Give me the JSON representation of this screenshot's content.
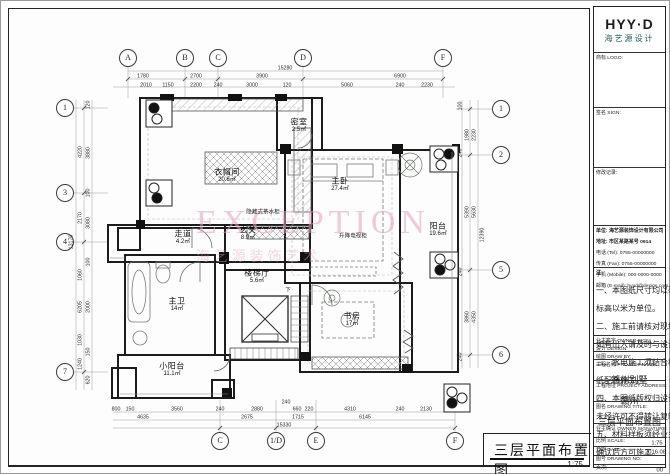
{
  "logo": {
    "title": "HYY·D",
    "subtitle": "海艺源设计"
  },
  "plan_title": {
    "text": "三层平面布置图",
    "scale": "1:75"
  },
  "watermark": {
    "text": "EXCEPTION",
    "cjk": "海 艺 源 装 饰 艺 术"
  },
  "colors": {
    "line": "#1c1c1c",
    "watermark_pink": "#e3a0be",
    "logo_teal": "#1b5e5a"
  },
  "grid_bubbles": [
    {
      "label": "A",
      "x": 128,
      "y": 58
    },
    {
      "label": "B",
      "x": 185,
      "y": 58
    },
    {
      "label": "C",
      "x": 218,
      "y": 58
    },
    {
      "label": "D",
      "x": 303,
      "y": 58
    },
    {
      "label": "F",
      "x": 443,
      "y": 58
    },
    {
      "label": "C",
      "x": 220,
      "y": 441
    },
    {
      "label": "1/D",
      "x": 276,
      "y": 441
    },
    {
      "label": "E",
      "x": 316,
      "y": 441
    },
    {
      "label": "F",
      "x": 455,
      "y": 441
    },
    {
      "label": "1",
      "x": 65,
      "y": 108
    },
    {
      "label": "3",
      "x": 65,
      "y": 193
    },
    {
      "label": "4",
      "x": 65,
      "y": 242
    },
    {
      "label": "7",
      "x": 65,
      "y": 372
    },
    {
      "label": "1",
      "x": 501,
      "y": 109
    },
    {
      "label": "2",
      "x": 501,
      "y": 155
    },
    {
      "label": "5",
      "x": 501,
      "y": 270
    },
    {
      "label": "6",
      "x": 501,
      "y": 355
    }
  ],
  "rooms": [
    {
      "name": "密室",
      "area": "2.5㎡",
      "x": 299,
      "y": 126
    },
    {
      "name": "衣帽间",
      "area": "20.6㎡",
      "x": 227,
      "y": 176
    },
    {
      "name": "主卧",
      "area": "27.4㎡",
      "x": 340,
      "y": 185
    },
    {
      "name": "阳台",
      "area": "19.6㎡",
      "x": 438,
      "y": 230
    },
    {
      "name": "走道",
      "area": "4.2㎡",
      "x": 183,
      "y": 238
    },
    {
      "name": "玄关",
      "area": "8.9㎡",
      "x": 248,
      "y": 234
    },
    {
      "name": "楼梯厅",
      "area": "5.6㎡",
      "x": 257,
      "y": 277
    },
    {
      "name": "主卫",
      "area": "14㎡",
      "x": 177,
      "y": 305
    },
    {
      "name": "书房",
      "area": "17㎡",
      "x": 352,
      "y": 320
    },
    {
      "name": "小阳台",
      "area": "11.1㎡",
      "x": 172,
      "y": 370
    }
  ],
  "annotations": [
    {
      "text": "隐藏式茶水柜",
      "x": 263,
      "y": 212
    },
    {
      "text": "升降电视柜",
      "x": 353,
      "y": 236
    },
    {
      "text": "下",
      "x": 288,
      "y": 290
    }
  ],
  "dims_top": [
    {
      "t": "15280",
      "x": 285,
      "y": 68
    },
    {
      "t": "1780",
      "x": 143,
      "y": 76
    },
    {
      "t": "2700",
      "x": 196,
      "y": 76
    },
    {
      "t": "3900",
      "x": 262,
      "y": 76
    },
    {
      "t": "6900",
      "x": 400,
      "y": 76
    },
    {
      "t": "2010",
      "x": 146,
      "y": 85
    },
    {
      "t": "1150",
      "x": 168,
      "y": 85
    },
    {
      "t": "2200",
      "x": 196,
      "y": 85
    },
    {
      "t": "240",
      "x": 218,
      "y": 85
    },
    {
      "t": "3000",
      "x": 252,
      "y": 85
    },
    {
      "t": "120",
      "x": 287,
      "y": 85
    },
    {
      "t": "5060",
      "x": 347,
      "y": 85
    },
    {
      "t": "240",
      "x": 400,
      "y": 85
    },
    {
      "t": "2230",
      "x": 427,
      "y": 85
    }
  ],
  "dims_bottom": [
    {
      "t": "240",
      "x": 286,
      "y": 402
    },
    {
      "t": "800",
      "x": 116,
      "y": 409
    },
    {
      "t": "150",
      "x": 130,
      "y": 409
    },
    {
      "t": "3560",
      "x": 177,
      "y": 409
    },
    {
      "t": "240",
      "x": 220,
      "y": 409
    },
    {
      "t": "2880",
      "x": 257,
      "y": 409
    },
    {
      "t": "660",
      "x": 297,
      "y": 409
    },
    {
      "t": "220",
      "x": 309,
      "y": 409
    },
    {
      "t": "4310",
      "x": 350,
      "y": 409
    },
    {
      "t": "240",
      "x": 400,
      "y": 409
    },
    {
      "t": "2130",
      "x": 426,
      "y": 409
    },
    {
      "t": "4635",
      "x": 143,
      "y": 417
    },
    {
      "t": "2675",
      "x": 247,
      "y": 417
    },
    {
      "t": "1715",
      "x": 298,
      "y": 417
    },
    {
      "t": "6145",
      "x": 365,
      "y": 417
    },
    {
      "t": "15330",
      "x": 284,
      "y": 425
    }
  ],
  "dims_left": [
    {
      "t": "120",
      "x": 88,
      "y": 105
    },
    {
      "t": "4220",
      "x": 80,
      "y": 152
    },
    {
      "t": "3880",
      "x": 88,
      "y": 153
    },
    {
      "t": "100",
      "x": 88,
      "y": 193
    },
    {
      "t": "2170",
      "x": 80,
      "y": 218
    },
    {
      "t": "3080",
      "x": 88,
      "y": 223
    },
    {
      "t": "13170",
      "x": 71,
      "y": 242
    },
    {
      "t": "100",
      "x": 88,
      "y": 262
    },
    {
      "t": "1060",
      "x": 80,
      "y": 275
    },
    {
      "t": "6205",
      "x": 80,
      "y": 307
    },
    {
      "t": "2000",
      "x": 88,
      "y": 307
    },
    {
      "t": "1030",
      "x": 80,
      "y": 340
    },
    {
      "t": "150",
      "x": 88,
      "y": 352
    },
    {
      "t": "1240",
      "x": 80,
      "y": 364
    },
    {
      "t": "620",
      "x": 88,
      "y": 380
    }
  ],
  "dims_right": [
    {
      "t": "100",
      "x": 460,
      "y": 106
    },
    {
      "t": "1980",
      "x": 467,
      "y": 135
    },
    {
      "t": "2230",
      "x": 474,
      "y": 135
    },
    {
      "t": "240",
      "x": 460,
      "y": 153
    },
    {
      "t": "5390",
      "x": 467,
      "y": 212
    },
    {
      "t": "5630",
      "x": 474,
      "y": 212
    },
    {
      "t": "12390",
      "x": 482,
      "y": 235
    },
    {
      "t": "240",
      "x": 460,
      "y": 272
    },
    {
      "t": "3860",
      "x": 467,
      "y": 317
    },
    {
      "t": "4350",
      "x": 474,
      "y": 317
    },
    {
      "t": "240",
      "x": 460,
      "y": 357
    }
  ],
  "title_block": {
    "logo_row_label": "商标 LOGO:",
    "sign_label": "签名 SIGN:",
    "revision_label": "修改记录:",
    "company_lines": [
      "单位: 海艺源装饰设计有限公司",
      "地址: 市区某路某号 0914"
    ],
    "contact_rows": [
      "电话 (Tel): 0755-00000000",
      "传真 (Fax): 0755-00000000",
      "手机 (Mobile): 000-0000-0000",
      "邮箱 (E-mail): hyyd@design.com"
    ],
    "notes_title": "注:",
    "notes": [
      "一、本图纸尺寸均以毫米为单位,",
      "标高以米为单位。",
      "二、施工前请核对现场实际尺寸,",
      "如有出入请及时与设计师联系。",
      "三、水电施工须结合相关专业图",
      "纸配合施工。",
      "四、本图纸版权归设计方所有,",
      "未经许可不得转让复制。",
      "五、材料样板须经业主及设计师",
      "确认后方可施工。"
    ],
    "owner_sign_label": "业主签字 OWNER SIGN:",
    "design_label": "设计 DESIGN:",
    "draw_label": "绘图 DRAW BY:",
    "project_name_label": "工程名称 PROJECT NAME:",
    "project_name": "赣州别墅",
    "project_addr_label": "工程地址 PROJECT ADDRESS:",
    "project_addr": "赣州",
    "drawing_title_label": "图名 DRAWING TITLE:",
    "drawing_title": "三层平面布置图",
    "owner_confirm_label": "业主确认 OWNER SIGNATURE:",
    "scale_label": "比例 SCALE:",
    "scale": "1:75",
    "date_label": "日期 DATE:",
    "date": "2016.08",
    "no_label": "图号 DRAWING NO:",
    "no": "PL-06",
    "page_label": "页次:",
    "page": "00"
  }
}
